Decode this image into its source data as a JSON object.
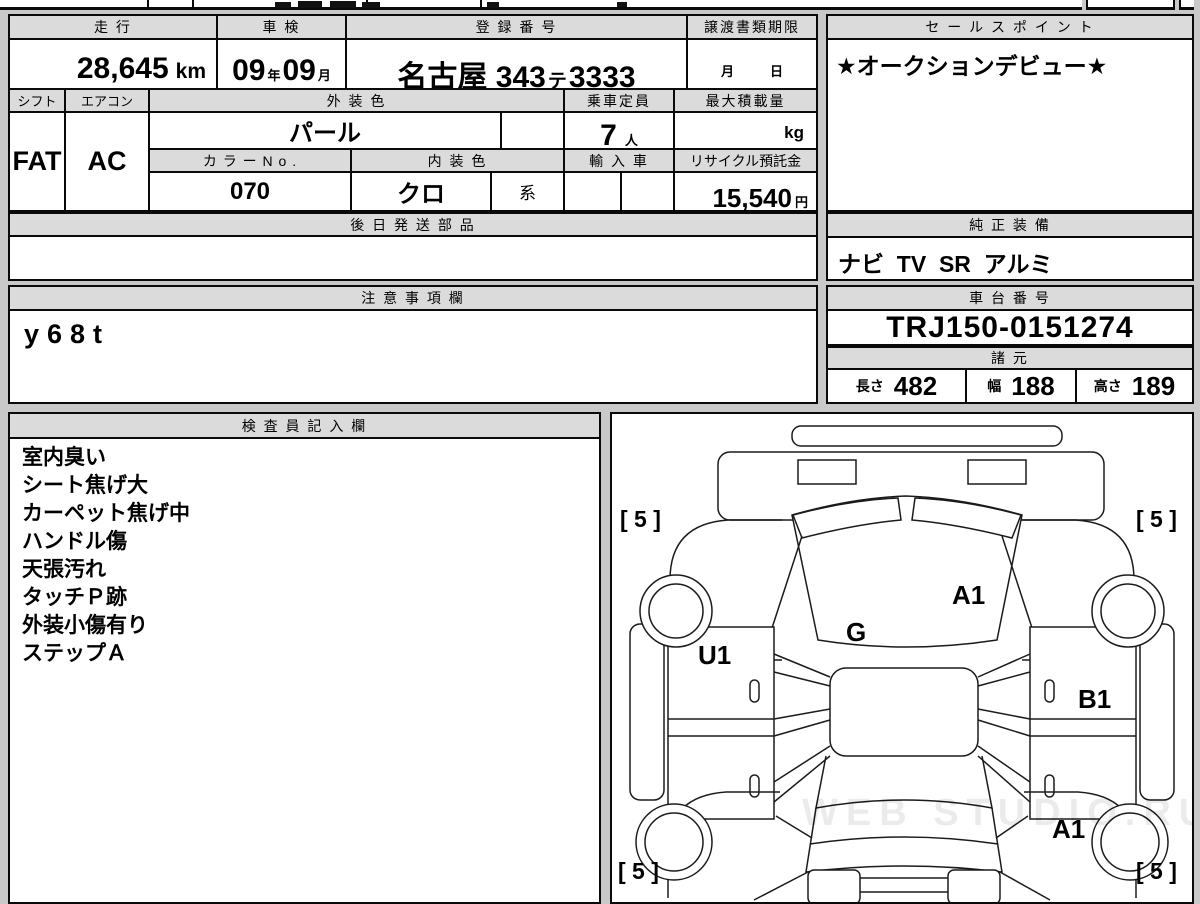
{
  "table": {
    "mileage": {
      "label": "走 行",
      "value": "28,645",
      "unit": "km"
    },
    "shaken": {
      "label": "車 検",
      "year": "09",
      "year_unit": "年",
      "month": "09",
      "month_unit": "月"
    },
    "registration": {
      "label": "登 録 番 号",
      "area": "名古屋 343",
      "kana": "テ",
      "number": "3333"
    },
    "deadline": {
      "label": "譲渡書類期限",
      "month_unit": "月",
      "day_unit": "日"
    },
    "shift": {
      "label": "シフト",
      "value": "FAT"
    },
    "aircon": {
      "label": "エアコン",
      "value": "AC"
    },
    "exterior_color": {
      "label": "外 装 色",
      "value": "パール"
    },
    "capacity": {
      "label": "乗車定員",
      "value": "7",
      "unit": "人"
    },
    "max_load": {
      "label": "最大積載量",
      "unit": "kg"
    },
    "color_no": {
      "label": "カ ラ ー N o .",
      "value": "070"
    },
    "interior_color": {
      "label": "内 装 色",
      "value": "クロ",
      "suffix": "系"
    },
    "import_car": {
      "label": "輸 入 車"
    },
    "recycle": {
      "label": "リサイクル預託金",
      "value": "15,540",
      "unit": "円"
    },
    "later_parts": {
      "label": "後 日 発 送 部 品"
    }
  },
  "sales_point": {
    "label": "セ ー ル ス ポ イ ン ト",
    "value": "★オークションデビュー★"
  },
  "equipment": {
    "label": "純 正 装 備",
    "value": "ナビ  TV  SR  アルミ"
  },
  "notes": {
    "label": "注 意 事 項 欄",
    "value": "y68t"
  },
  "chassis": {
    "label": "車 台 番 号",
    "value": "TRJ150-0151274"
  },
  "specs": {
    "label": "諸 元",
    "length_label": "長さ",
    "length": "482",
    "width_label": "幅",
    "width": "188",
    "height_label": "高さ",
    "height": "189"
  },
  "inspector": {
    "label": "検 査 員 記 入 欄",
    "items": [
      "室内臭い",
      "シート焦げ大",
      "カーペット焦げ中",
      "ハンドル傷",
      "天張汚れ",
      "タッチＰ跡",
      "外装小傷有り",
      "ステップＡ"
    ]
  },
  "diagram": {
    "labels": [
      "[ 5 ]",
      "[ 5 ]",
      "A1",
      "G",
      "U1",
      "B1",
      "A1",
      "[ 5 ]",
      "[ 5 ]"
    ],
    "watermark": "WEB STUDIO.RU"
  }
}
